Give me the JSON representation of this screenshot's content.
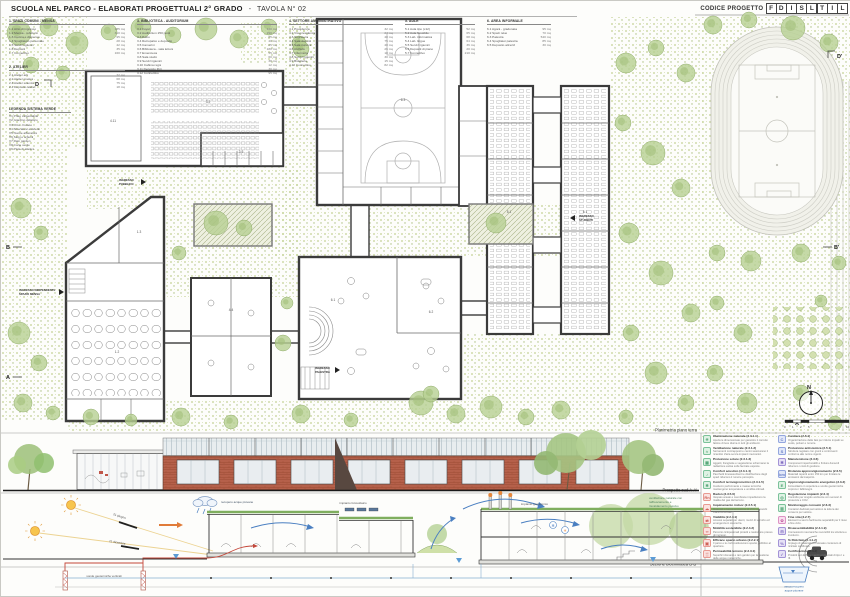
{
  "sheet": {
    "title": "SCUOLA NEL PARCO - ELABORATI PROGETTUALI 2° GRADO",
    "sep": "-",
    "tavola": "TAVOLA N° 02",
    "codice_label": "CODICE PROGETTO",
    "codice_letters": [
      "F",
      "D",
      "I",
      "S",
      "L",
      "T",
      "I",
      "L"
    ]
  },
  "schedule": {
    "col1": {
      "title": "1. SPAZI COMUNI - MENSA",
      "items": [
        {
          "n": "1.1  Atrio di ingresso",
          "a": "185 mq"
        },
        {
          "n": "1.2  Mensa - refettorio",
          "a": "310 mq"
        },
        {
          "n": "1.3  Cucina e dispensa",
          "a": "95 mq"
        },
        {
          "n": "1.4  Spogliatoio personale",
          "a": "28 mq"
        },
        {
          "n": "1.5  Servizi igienici",
          "a": "42 mq"
        },
        {
          "n": "1.6  Depositi",
          "a": "35 mq"
        },
        {
          "n": "1.7  Connettivo",
          "a": "160 mq"
        }
      ]
    },
    "col1b": {
      "title": "2. ATELIER",
      "items": [
        {
          "n": "2.1  Atelier arti",
          "a": "72 mq"
        },
        {
          "n": "2.2  Atelier musica",
          "a": "68 mq"
        },
        {
          "n": "2.3  Atelier scienze",
          "a": "75 mq"
        },
        {
          "n": "2.4  Deposito atelier",
          "a": "18 mq"
        }
      ]
    },
    "verde": {
      "title": "LEGENDA SISTEMA VERDE",
      "items": [
        {
          "n": "V1  Prato calpestabile",
          "a": ""
        },
        {
          "n": "V2  Giardino didattico",
          "a": ""
        },
        {
          "n": "V3  Orto - frutteto",
          "a": ""
        },
        {
          "n": "V4  Alberature esistenti",
          "a": ""
        },
        {
          "n": "V5  Nuove alberature",
          "a": ""
        },
        {
          "n": "V6  Siepi e arbusti",
          "a": ""
        },
        {
          "n": "V7  Rain garden",
          "a": ""
        },
        {
          "n": "V8  Corte verde",
          "a": ""
        },
        {
          "n": "V9  Pista di atletica",
          "a": ""
        }
      ]
    },
    "col2": {
      "title": "3. BIBLIOTECA - AUDITORIUM",
      "items": [
        {
          "n": "3.1  Foyer",
          "a": "120 mq"
        },
        {
          "n": "3.2  Auditorium 250 posti",
          "a": "290 mq"
        },
        {
          "n": "3.3  Palco",
          "a": "85 mq"
        },
        {
          "n": "3.4  Retropalco e deposito",
          "a": "40 mq"
        },
        {
          "n": "3.5  Camerini",
          "a": "25 mq"
        },
        {
          "n": "3.6  Biblioteca - sala lettura",
          "a": "180 mq"
        },
        {
          "n": "3.7  Emeroteca",
          "a": "55 mq"
        },
        {
          "n": "3.8  Sala studio",
          "a": "60 mq"
        },
        {
          "n": "3.9  Servizi igienici",
          "a": "38 mq"
        },
        {
          "n": "3.10 Cabina regia",
          "a": "12 mq"
        },
        {
          "n": "3.11 Deposito libri",
          "a": "30 mq"
        },
        {
          "n": "3.12 Connettivo",
          "a": "95 mq"
        }
      ]
    },
    "col3": {
      "title": "4. SETTORE AMMINISTRATIVO",
      "items": [
        {
          "n": "4.1  Presidenza",
          "a": "32 mq"
        },
        {
          "n": "4.2  Vicepresidenza",
          "a": "24 mq"
        },
        {
          "n": "4.3  Segreteria",
          "a": "48 mq"
        },
        {
          "n": "4.4  Sala docenti",
          "a": "75 mq"
        },
        {
          "n": "4.5  Sala riunioni",
          "a": "40 mq"
        },
        {
          "n": "4.6  Archivio",
          "a": "26 mq"
        },
        {
          "n": "4.7  Infermeria",
          "a": "18 mq"
        },
        {
          "n": "4.8  Servizi igienici",
          "a": "30 mq"
        },
        {
          "n": "4.9  Bidelleria",
          "a": "15 mq"
        },
        {
          "n": "4.10 Connettivo",
          "a": "82 mq"
        }
      ]
    },
    "col4": {
      "title": "5. AULE",
      "items": [
        {
          "n": "5.1  Aula tipo (x12)",
          "a": "52 mq"
        },
        {
          "n": "5.2  Aula flessibile",
          "a": "65 mq"
        },
        {
          "n": "5.3  Lab. informatica",
          "a": "68 mq"
        },
        {
          "n": "5.4  Lab. lingue",
          "a": "64 mq"
        },
        {
          "n": "5.5  Servizi igienici",
          "a": "36 mq"
        },
        {
          "n": "5.6  Depositi di piano",
          "a": "20 mq"
        },
        {
          "n": "5.7  Connettivo",
          "a": "210 mq"
        }
      ]
    },
    "col5": {
      "title": "6. AREA INFORMALE",
      "items": [
        {
          "n": "6.1  Agorà - gradonata",
          "a": "95 mq"
        },
        {
          "n": "6.2  Spazi relax",
          "a": "70 mq"
        },
        {
          "n": "6.3  Palestra",
          "a": "540 mq"
        },
        {
          "n": "6.4  Spogliatoi palestra",
          "a": "85 mq"
        },
        {
          "n": "6.5  Deposito attrezzi",
          "a": "30 mq"
        }
      ]
    }
  },
  "plan": {
    "band_labels": {
      "plan": "Planimetria piano terra",
      "elevation": "Prospetto sud A-A'",
      "section": "Sezione bioclimatica B-B'"
    },
    "labels": {
      "mensa_1": "INGRESSO INDIPENDENTE",
      "mensa_2": "SPAZIO MENSA",
      "pubblico_1": "INGRESSO",
      "pubblico_2": "PUBBLICO",
      "studenti_1": "INGRESSO",
      "studenti_2": "STUDENTI",
      "palestra_1": "INGRESSO",
      "palestra_2": "PALESTRA"
    },
    "markers": {
      "d": "D",
      "d1": "D'",
      "b": "B",
      "b1": "B'",
      "a": "A",
      "a1": "A'"
    },
    "compass_n": "N",
    "scale_ticks": [
      "0",
      "1",
      "2",
      "5",
      "10"
    ],
    "room_numbers": [
      {
        "x": 112,
        "y": 121,
        "t": "4.11"
      },
      {
        "x": 207,
        "y": 102,
        "t": "3.2"
      },
      {
        "x": 402,
        "y": 100,
        "t": "6.3"
      },
      {
        "x": 116,
        "y": 352,
        "t": "1.2"
      },
      {
        "x": 138,
        "y": 232,
        "t": "1.3"
      },
      {
        "x": 508,
        "y": 212,
        "t": "5.1"
      },
      {
        "x": 584,
        "y": 212,
        "t": "5.1"
      },
      {
        "x": 332,
        "y": 300,
        "t": "6.1"
      },
      {
        "x": 430,
        "y": 312,
        "t": "6.2"
      },
      {
        "x": 240,
        "y": 152,
        "t": "3.9"
      },
      {
        "x": 230,
        "y": 310,
        "t": "4.4"
      }
    ],
    "trees": [
      [
        18,
        32,
        12
      ],
      [
        48,
        26,
        9
      ],
      [
        76,
        42,
        11
      ],
      [
        108,
        31,
        8
      ],
      [
        140,
        27,
        10
      ],
      [
        172,
        34,
        8
      ],
      [
        205,
        28,
        11
      ],
      [
        238,
        38,
        9
      ],
      [
        268,
        26,
        8
      ],
      [
        298,
        42,
        7
      ],
      [
        30,
        64,
        8
      ],
      [
        62,
        72,
        7
      ],
      [
        300,
        48,
        8
      ],
      [
        20,
        207,
        10
      ],
      [
        40,
        232,
        7
      ],
      [
        18,
        332,
        11
      ],
      [
        38,
        362,
        8
      ],
      [
        22,
        402,
        9
      ],
      [
        52,
        412,
        7
      ],
      [
        178,
        252,
        7
      ],
      [
        282,
        342,
        8
      ],
      [
        286,
        302,
        6
      ],
      [
        90,
        416,
        8
      ],
      [
        130,
        419,
        6
      ],
      [
        180,
        416,
        9
      ],
      [
        230,
        421,
        7
      ],
      [
        300,
        413,
        9
      ],
      [
        350,
        419,
        7
      ],
      [
        420,
        402,
        12
      ],
      [
        455,
        413,
        9
      ],
      [
        490,
        406,
        11
      ],
      [
        525,
        416,
        8
      ],
      [
        560,
        409,
        9
      ],
      [
        430,
        393,
        8
      ],
      [
        625,
        62,
        10
      ],
      [
        655,
        47,
        8
      ],
      [
        685,
        72,
        9
      ],
      [
        622,
        122,
        8
      ],
      [
        652,
        152,
        12
      ],
      [
        680,
        187,
        9
      ],
      [
        628,
        232,
        10
      ],
      [
        660,
        272,
        12
      ],
      [
        690,
        312,
        9
      ],
      [
        630,
        332,
        8
      ],
      [
        655,
        372,
        11
      ],
      [
        685,
        402,
        8
      ],
      [
        625,
        416,
        7
      ],
      [
        712,
        24,
        9
      ],
      [
        748,
        19,
        8
      ],
      [
        792,
        27,
        12
      ],
      [
        828,
        42,
        9
      ],
      [
        716,
        252,
        8
      ],
      [
        750,
        260,
        10
      ],
      [
        800,
        252,
        9
      ],
      [
        838,
        262,
        7
      ],
      [
        716,
        302,
        7
      ],
      [
        742,
        332,
        9
      ],
      [
        714,
        372,
        8
      ],
      [
        746,
        402,
        10
      ],
      [
        800,
        392,
        8
      ],
      [
        834,
        422,
        7
      ],
      [
        820,
        300,
        6
      ],
      [
        215,
        222,
        12
      ],
      [
        243,
        227,
        8
      ],
      [
        495,
        222,
        10
      ]
    ]
  },
  "section_annotations": {
    "sun_summer": "21 giugno",
    "sun_winter": "21 dicembre",
    "rain": "recupero acque piovane",
    "pv": "impianto fotovoltaico",
    "geo": "impianto geotermico",
    "probes": "sonde geotermiche verticali",
    "tank_1": "vasca recupero",
    "tank_2": "acque piovane",
    "vent_1": "ventilazione naturale con",
    "vent_2": "raffrescamento e",
    "vent_3": "riscaldamento passivo"
  },
  "sustainability": {
    "left": [
      {
        "t": "Illuminazione naturale (2.3.1.1)",
        "d": "Aperture dimensionate per garantire il corretto fattore di luce diurna in tutti gli ambienti.",
        "g": "☀",
        "bg": "#dff2e4",
        "bd": "#7cc29a",
        "ink": "#4ea273"
      },
      {
        "t": "Ventilazione naturale (2.3.1.2)",
        "d": "Serramenti contrapposti e camini assicurano il ricambio d'aria senza impianti meccanici.",
        "g": "≈",
        "bg": "#dff2e4",
        "bd": "#7cc29a",
        "ink": "#4ea273"
      },
      {
        "t": "Protezione solare (2.3.1.3)",
        "d": "Aggetti, frangisole e vegetazione schermano la radiazione estiva sulle facciate esposte.",
        "g": "▦",
        "bg": "#dff2e4",
        "bd": "#7cc29a",
        "ink": "#4ea273"
      },
      {
        "t": "Comfort acustico (2.3.1.4)",
        "d": "Pacchetti fonoassorbenti e distribuzione degli spazi riducono il rumore percepito.",
        "g": "♪",
        "bg": "#dff2e4",
        "bd": "#7cc29a",
        "ink": "#4ea273"
      },
      {
        "t": "Comfort termoigrometrico (2.3.1.5)",
        "d": "Involucro performante e masse termiche mantengono temperatura e umidità ottimali.",
        "g": "❄",
        "bg": "#dff2e4",
        "bd": "#7cc29a",
        "ink": "#4ea273"
      },
      {
        "t": "Radon (2.3.5.6)",
        "d": "Vespaio areato e membrane impediscono la risalita del gas dal terreno.",
        "g": "Rn",
        "bg": "#fbe3e1",
        "bd": "#e89a92",
        "ink": "#cf6258"
      },
      {
        "t": "Inquinamento indoor (2.3.5.1)",
        "d": "Materiali a bassa emissione di VOC e ricambi d'aria controllati.",
        "g": "☁",
        "bg": "#fbe3e1",
        "bd": "#e89a92",
        "ink": "#cf6258"
      },
      {
        "t": "Viabilità (2.2.4.1)",
        "d": "Accessi separati per utenti, mezzi di servizio ed emergenza in sicurezza.",
        "g": "⇄",
        "bg": "#fbe3e1",
        "bd": "#e89a92",
        "ink": "#cf6258"
      },
      {
        "t": "Mobilità sostenibile (2.2.4.2)",
        "d": "Percorsi ciclopedonali protetti e rastrelliere presso gli ingressi.",
        "g": "∞",
        "bg": "#fbe3e1",
        "bd": "#e89a92",
        "ink": "#cf6258"
      },
      {
        "t": "Efficace spazio urbano (2.2.2.1)",
        "d": "Il parco e le corti restituiscono spazio pubblico al quartiere.",
        "g": "▣",
        "bg": "#fbe3e1",
        "bd": "#e89a92",
        "ink": "#cf6258"
      },
      {
        "t": "Permeabilità terreno (2.2.3.1)",
        "d": "Superfici drenanti e rain garden per la gestione delle acque meteoriche.",
        "g": "▒",
        "bg": "#fbe3e1",
        "bd": "#e89a92",
        "ink": "#cf6258"
      }
    ],
    "right": [
      {
        "t": "Cantiere (2.6.1)",
        "d": "Organizzazione delle fasi per ridurre impatti su suolo, polveri e rumore.",
        "g": "C",
        "bg": "#e1e7f8",
        "bd": "#93a6de",
        "ink": "#6a7fc4"
      },
      {
        "t": "Protezione antisismica (2.5.1)",
        "d": "Struttura regolare con giunti e controventi conforme alle norme vigenti.",
        "g": "S",
        "bg": "#e1e7f8",
        "bd": "#93a6de",
        "ink": "#6a7fc4"
      },
      {
        "t": "Manutenzione (2.3.6)",
        "d": "Componenti ispezionabili e finiture durevoli riducono i costi di gestione.",
        "g": "✱",
        "bg": "#e6e1f5",
        "bd": "#a393d6",
        "ink": "#7f6bbf"
      },
      {
        "t": "Distanza approvvigionamento (2.6.5)",
        "d": "Materiali reperiti entro 150 km per limitare le emissioni da trasporto.",
        "g": "km",
        "bg": "#e1e7f8",
        "bd": "#93a6de",
        "ink": "#6a7fc4"
      },
      {
        "t": "Approvvigionamento energetico (2.3.2)",
        "d": "Fotovoltaico in copertura e sonde geotermiche coprono i fabbisogni.",
        "g": "E",
        "bg": "#dff2e4",
        "bd": "#7cc29a",
        "ink": "#4ea273"
      },
      {
        "t": "Regolazione impianti (2.3.4)",
        "d": "Controllo per singolo ambiente con sensori di presenza e CO2.",
        "g": "◎",
        "bg": "#dff2e4",
        "bd": "#7cc29a",
        "ink": "#4ea273"
      },
      {
        "t": "Monitoraggio consumi (2.6.3)",
        "d": "Contatori dedicati permettono la lettura dei consumi per settore.",
        "g": "▥",
        "bg": "#dff2e4",
        "bd": "#7cc29a",
        "ink": "#4ea273"
      },
      {
        "t": "Fine vita (2.2.7)",
        "d": "Elementi a secco facilmente separabili per il riuso a fine ciclo.",
        "g": "✿",
        "bg": "#f9e0f0",
        "bd": "#dd93c4",
        "ink": "#c261a0"
      },
      {
        "t": "Disassemblabilità (2.4.1.9)",
        "d": "Connessioni meccaniche reversibili tra struttura e involucro.",
        "g": "⊟",
        "bg": "#e6e1f5",
        "bd": "#a393d6",
        "ink": "#7f6bbf"
      },
      {
        "t": "% Riciclato (2.4.1.2)",
        "d": "Impiego di materiali con elevato contenuto di riciclato certificato.",
        "g": "%",
        "bg": "#e6e1f5",
        "bd": "#a393d6",
        "ink": "#7f6bbf"
      },
      {
        "t": "Certificazioni (2.4.2)",
        "d": "Prodotti con EPD e marchi ambientali di tipo I e III.",
        "g": "✓",
        "bg": "#e6e1f5",
        "bd": "#a393d6",
        "ink": "#7f6bbf"
      }
    ]
  },
  "colors": {
    "wall": "#3b3b3b",
    "vegetation": "#b7cf92",
    "brick": "#b5604a",
    "green_roof": "#7fae5e",
    "water": "#4a7fc1",
    "heat": "#c4473a",
    "sun": "#f7c54e"
  }
}
